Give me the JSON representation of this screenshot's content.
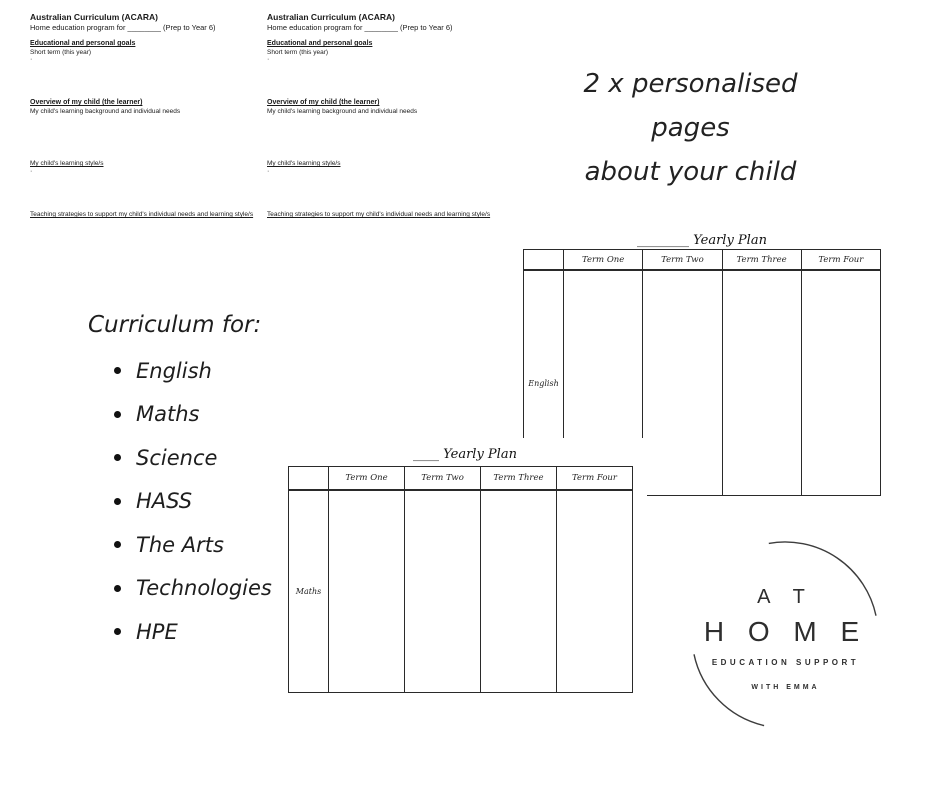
{
  "acara_page": {
    "title": "Australian Curriculum (ACARA)",
    "subtitle": "Home education program for ________ (Prep to Year 6)",
    "section1_heading": "Educational and personal goals",
    "section1_body": "Short term (this year)",
    "bullet_dot": "·",
    "section2_heading": "Overview of my child (the learner)",
    "section2_body": "My child's learning background and individual needs",
    "section3_heading": "My child's learning style/s",
    "section4_heading": "Teaching strategies to support my child's individual needs and learning style/s"
  },
  "note": {
    "line1": "2 x personalised pages",
    "line2": "about your child"
  },
  "curriculum": {
    "heading": "Curriculum for:",
    "items": [
      "English",
      "Maths",
      "Science",
      "HASS",
      "The Arts",
      "Technologies",
      "HPE"
    ]
  },
  "yearly_plan_top": {
    "title": "________ Yearly Plan",
    "columns": [
      "Term One",
      "Term Two",
      "Term Three",
      "Term Four"
    ],
    "row_label": "English"
  },
  "yearly_plan_bottom": {
    "title": "____ Yearly Plan",
    "columns": [
      "Term One",
      "Term Two",
      "Term Three",
      "Term Four"
    ],
    "row_label": "Maths"
  },
  "logo": {
    "line1": "A T",
    "line2": "H O M E",
    "line3": "EDUCATION SUPPORT",
    "line4": "WITH EMMA"
  },
  "colors": {
    "text": "#1a1a1a",
    "table_border": "#2a2a2a",
    "background": "#ffffff"
  }
}
